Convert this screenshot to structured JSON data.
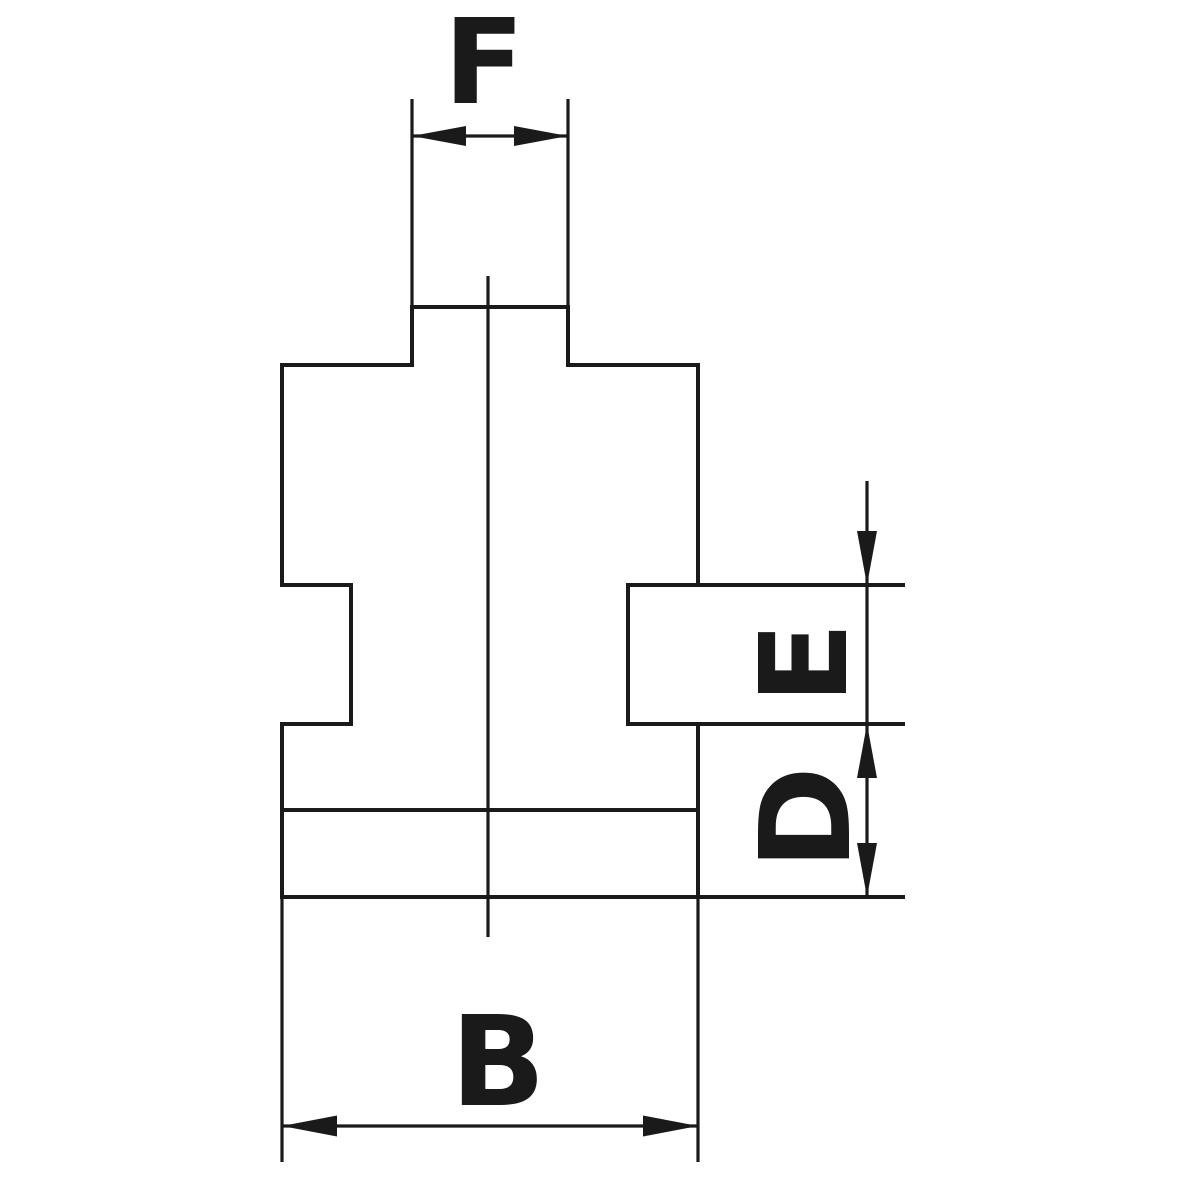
{
  "page": {
    "background_color": "#ffffff",
    "line_color": "#1a1a1a",
    "text_color": "#1a1a1a"
  },
  "drawing": {
    "type": "technical-dimension-drawing",
    "subject": "chuck-jaw-cross-section",
    "dimensions": {
      "tenon_width": {
        "label": "F"
      },
      "stop_block_height": {
        "label": "E"
      },
      "base_step_height": {
        "label": "D"
      },
      "body_width": {
        "label": "B"
      }
    }
  }
}
